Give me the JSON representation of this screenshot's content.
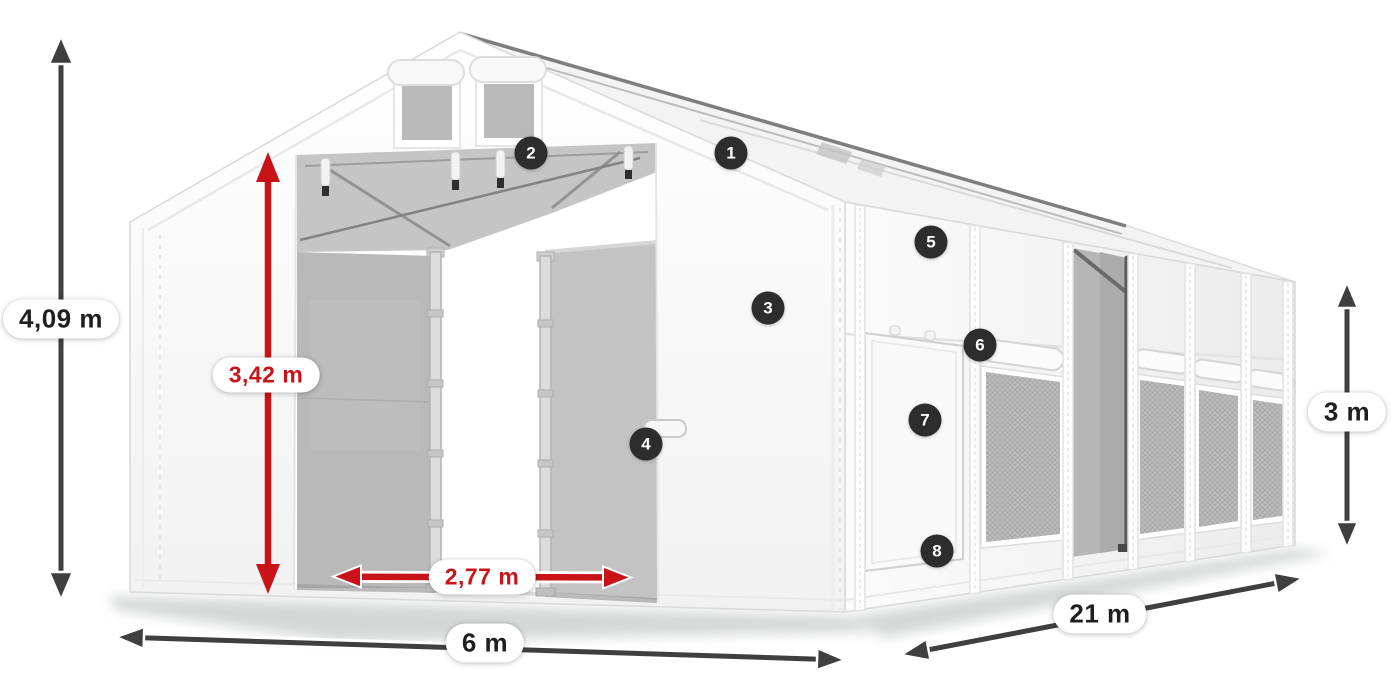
{
  "figure": {
    "kind": "product-dimension-diagram",
    "subject": "white-storage-tent"
  },
  "colors": {
    "accent_red": "#c81418",
    "arrow_dark": "#3f3f3f",
    "badge_bg": "#2d2d2d",
    "badge_text": "#ffffff",
    "pill_text": "#1f1f1f"
  },
  "dimensions": {
    "total_height": {
      "label": "4,09 m",
      "style": "dark",
      "orientation": "vertical"
    },
    "entrance_height": {
      "label": "3,42 m",
      "style": "red",
      "orientation": "vertical"
    },
    "entrance_width": {
      "label": "2,77 m",
      "style": "red",
      "orientation": "horizontal"
    },
    "width": {
      "label": "6 m",
      "style": "dark",
      "orientation": "horizontal"
    },
    "length": {
      "label": "21 m",
      "style": "dark",
      "orientation": "diagonal"
    },
    "side_height": {
      "label": "3 m",
      "style": "dark",
      "orientation": "vertical"
    }
  },
  "markers": [
    {
      "number": "1"
    },
    {
      "number": "2"
    },
    {
      "number": "3"
    },
    {
      "number": "4"
    },
    {
      "number": "5"
    },
    {
      "number": "6"
    },
    {
      "number": "7"
    },
    {
      "number": "8"
    }
  ]
}
